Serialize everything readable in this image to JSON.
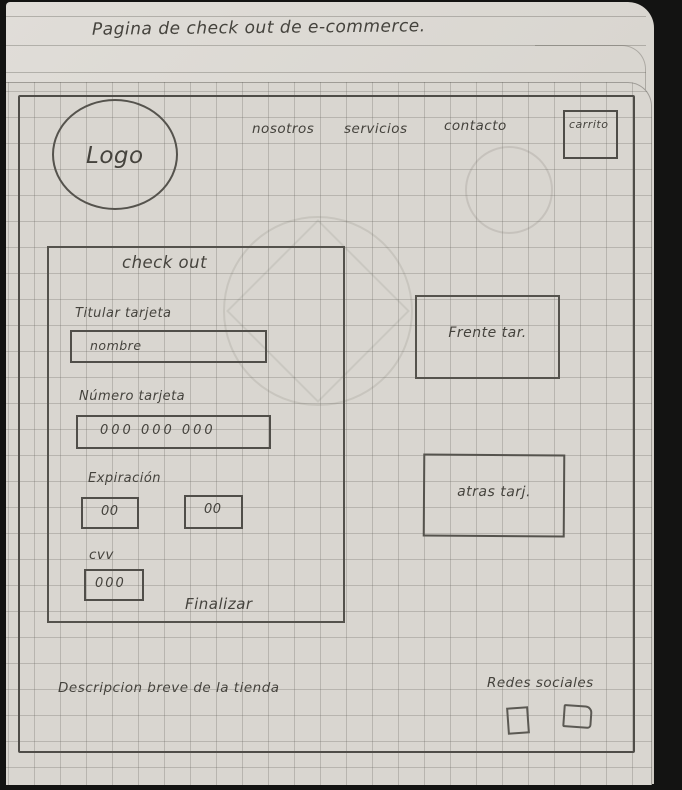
{
  "page": {
    "title": "Pagina de check out de e-commerce."
  },
  "nav": {
    "logo_label": "Logo",
    "items": [
      {
        "label": "nosotros"
      },
      {
        "label": "servicios"
      },
      {
        "label": "contacto"
      }
    ],
    "cart_label": "carrito",
    "cart_icon": "square-outline"
  },
  "checkout": {
    "heading": "check out",
    "card_holder_label": "Titular tarjeta",
    "card_holder_placeholder": "nombre",
    "card_number_label": "Número tarjeta",
    "card_number_placeholder": "000 000 000",
    "expiry_label": "Expiración",
    "expiry_month_placeholder": "00",
    "expiry_year_placeholder": "00",
    "cvv_label": "cvv",
    "cvv_placeholder": "000",
    "submit_label": "Finalizar"
  },
  "card_preview": {
    "front_label": "Frente tar.",
    "back_label": "atras tarj."
  },
  "footer": {
    "description": "Descripcion breve de la tienda",
    "social_label": "Redes sociales",
    "social_icons": [
      "square-placeholder",
      "square-placeholder"
    ]
  },
  "colors": {
    "background": "#0d0d0d",
    "paper": "#d9d6d0",
    "grid_line": "#b2b0aa",
    "pencil": "#504e49",
    "ink": "#45433d"
  }
}
